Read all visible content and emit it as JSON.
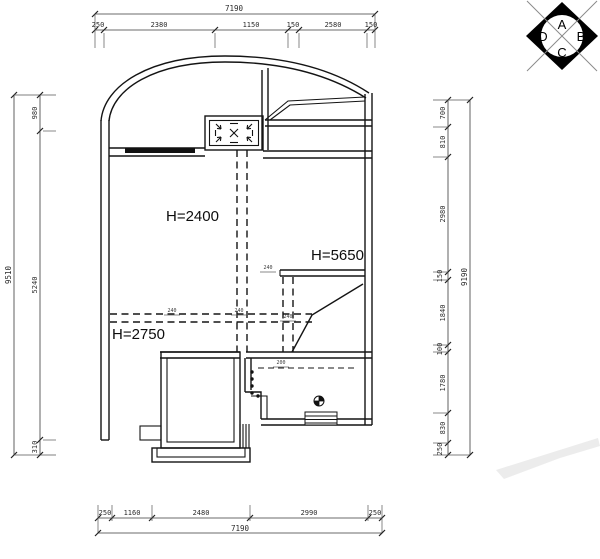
{
  "compass": {
    "top": "A",
    "right": "B",
    "bottom": "C",
    "left": "D"
  },
  "room_labels": {
    "h2400": "H=2400",
    "h5650": "H=5650",
    "h2750": "H=2750"
  },
  "dimensions": {
    "top": {
      "total": "7190",
      "segments": [
        "250",
        "2380",
        "1150",
        "150",
        "2580",
        "150"
      ]
    },
    "bottom": {
      "total": "7190",
      "segments": [
        "250",
        "1160",
        "2480",
        "2990",
        "250"
      ]
    },
    "left": {
      "total": "9510",
      "segments": [
        "980",
        "5240",
        "310"
      ]
    },
    "right": {
      "total": "9190",
      "segments": [
        "700",
        "810",
        "2980",
        "150",
        "1840",
        "100",
        "1780",
        "830",
        "250"
      ]
    }
  },
  "beam_dims": {
    "b1": "240",
    "b2": "240",
    "b3": "240",
    "b4": "240",
    "b5": "200"
  }
}
